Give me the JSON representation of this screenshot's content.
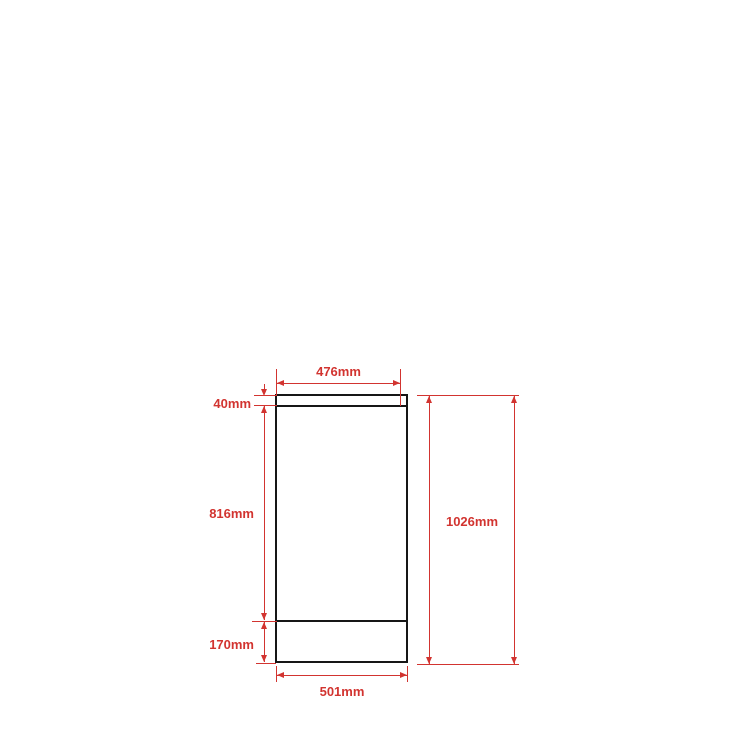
{
  "diagram": {
    "kind": "technical-dimension-drawing",
    "unit": "mm",
    "colors": {
      "dimension": "#d23430",
      "outline": "#161616",
      "background": "#ffffff"
    },
    "dimensions": {
      "top_width": {
        "label": "476mm",
        "value": 476
      },
      "top_height": {
        "label": "40mm",
        "value": 40
      },
      "middle_height": {
        "label": "816mm",
        "value": 816
      },
      "bottom_height": {
        "label": "170mm",
        "value": 170
      },
      "total_height": {
        "label": "1026mm",
        "value": 1026
      },
      "bottom_width": {
        "label": "501mm",
        "value": 501
      }
    }
  }
}
